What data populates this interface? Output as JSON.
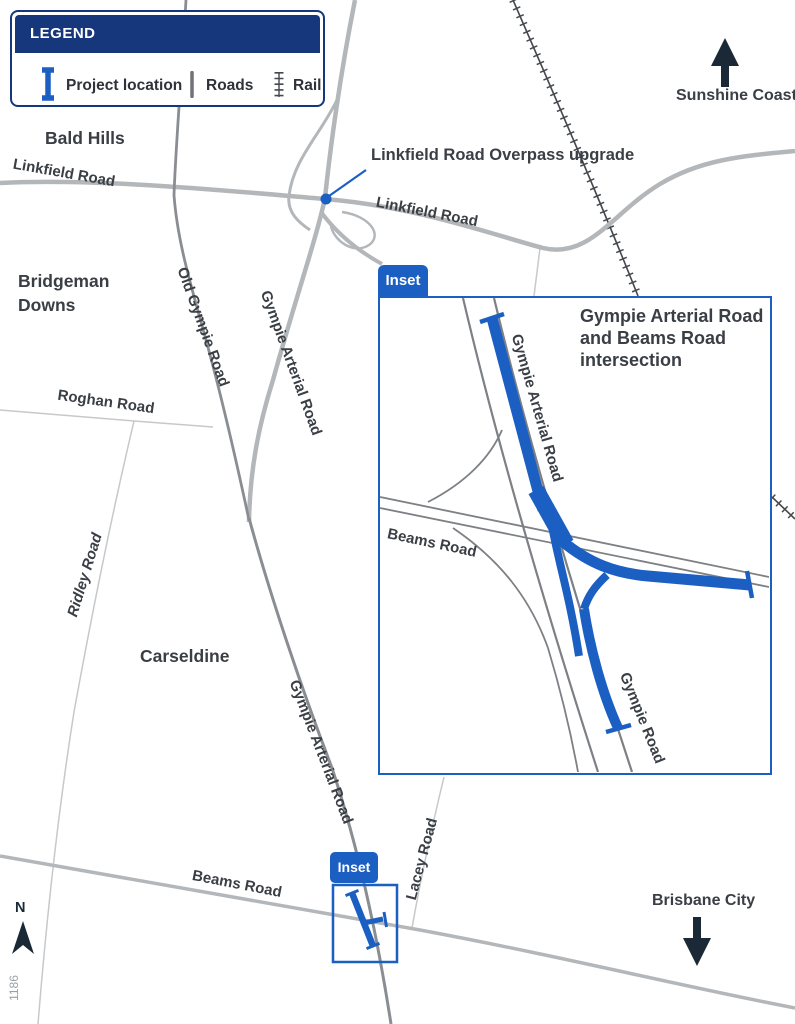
{
  "legend": {
    "title": "LEGEND",
    "project_location_label": "Project location",
    "roads_label": "Roads",
    "rail_label": "Rail"
  },
  "places": {
    "bald_hills": "Bald Hills",
    "bridgeman_downs": "Bridgeman Downs",
    "carseldine": "Carseldine"
  },
  "directions": {
    "north_letter": "N",
    "north_destination": "Sunshine Coast",
    "south_destination": "Brisbane City"
  },
  "callout": {
    "overpass_label": "Linkfield Road Overpass upgrade"
  },
  "roads": {
    "linkfield_west": "Linkfield Road",
    "linkfield_east": "Linkfield Road",
    "old_gympie": "Old Gympie Road",
    "gympie_arterial_north": "Gympie Arterial Road",
    "gympie_arterial_south": "Gympie Arterial Road",
    "roghan": "Roghan Road",
    "ridley": "Ridley Road",
    "beams": "Beams Road",
    "lacey": "Lacey Road"
  },
  "inset": {
    "tab_label": "Inset",
    "title": "Gympie Arterial Road and Beams Road intersection",
    "roads": {
      "gympie_arterial": "Gympie Arterial Road",
      "beams": "Beams Road",
      "gympie": "Gympie Road"
    }
  },
  "marker": {
    "tab_label": "Inset"
  },
  "map_number": "1186",
  "colors": {
    "project_blue": "#1c5fc3",
    "legend_navy": "#17377c",
    "road_gray": "#b4b7ba",
    "road_dark_gray": "#8a8d91",
    "road_thin_gray": "#c6c8ca",
    "rail_dark": "#45484d",
    "arrow_navy": "#1b2836",
    "label_text": "#3a3e45"
  }
}
